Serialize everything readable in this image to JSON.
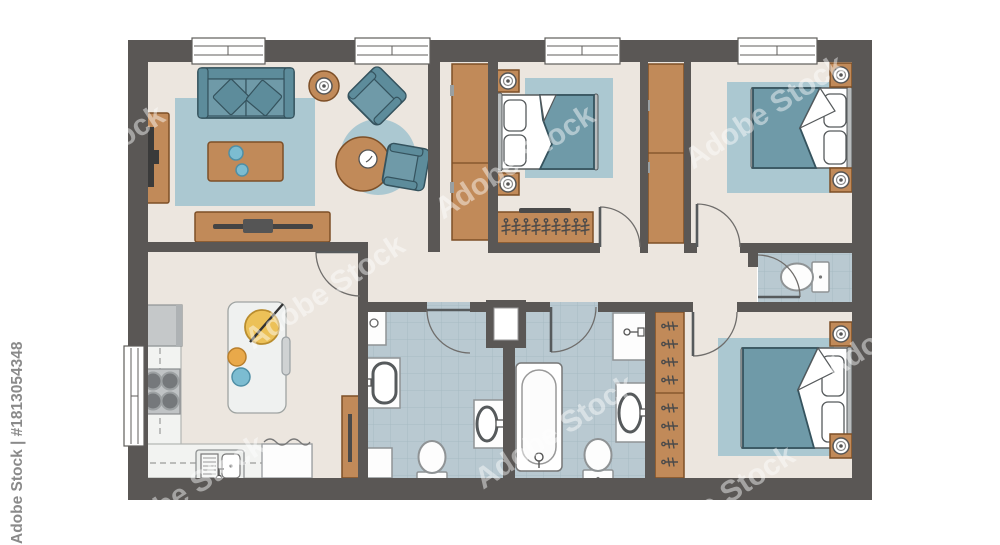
{
  "meta": {
    "description": "Architectural floor plan of a three-bedroom apartment with furniture, top view, stock illustration"
  },
  "watermark": {
    "brand": "Adobe Stock",
    "asset_id": "#1813054348",
    "full_text": "Adobe Stock | #1813054348",
    "diagonal_text": "Adobe Stock"
  },
  "colors": {
    "wall": "#5a5755",
    "floor": "#ece6df",
    "tile": "#b9c9d1",
    "tile_line": "#a6bac3",
    "rug": "#abc8d1",
    "teal": "#6f9aa8",
    "teal_dark": "#5d8c9b",
    "teal_outline": "#35535e",
    "wood": "#c18a59",
    "wood_dark": "#7d4f27",
    "counter": "#f2f3f1",
    "appliance": "#c5c8c9",
    "burner": "#75787b",
    "yellow": "#ecc158",
    "orange": "#e9a94a",
    "blue": "#7cbcd1",
    "fixture": "#fdfdfd",
    "line": "#565a5c",
    "watermark_gray": "#8a8a8a"
  },
  "plan": {
    "rooms": [
      {
        "name": "living-room",
        "items": [
          "sofa",
          "coffee-table",
          "tv-console",
          "media-sideboard",
          "armchair",
          "armchair",
          "round-coffee-table",
          "plant-side-table",
          "area-rug",
          "round-rug"
        ]
      },
      {
        "name": "kitchen",
        "items": [
          "fridge",
          "l-shaped-counter",
          "cooktop",
          "double-sink",
          "dishwasher",
          "kitchen-island",
          "cutting-board",
          "bench",
          "tall-cabinet"
        ]
      },
      {
        "name": "bedroom-top-middle",
        "items": [
          "double-bed",
          "nightstand",
          "nightstand",
          "table-lamp",
          "table-lamp",
          "area-rug",
          "wardrobe",
          "wardrobe",
          "clothes-rack"
        ]
      },
      {
        "name": "bedroom-top-right",
        "items": [
          "double-bed",
          "nightstand",
          "nightstand",
          "table-lamp",
          "table-lamp",
          "area-rug"
        ]
      },
      {
        "name": "bedroom-bottom-right",
        "items": [
          "double-bed",
          "nightstand",
          "nightstand",
          "table-lamp",
          "table-lamp",
          "area-rug",
          "open-wardrobe"
        ]
      },
      {
        "name": "bathroom-left",
        "items": [
          "sink-vanity",
          "sink-vanity",
          "toilet",
          "washing-machine",
          "wall-cabinet"
        ]
      },
      {
        "name": "bathroom-middle",
        "items": [
          "bathtub",
          "toilet",
          "sink-vanity",
          "counter"
        ]
      },
      {
        "name": "wc",
        "items": [
          "toilet"
        ]
      },
      {
        "name": "hallway",
        "items": [
          "duct"
        ]
      }
    ]
  }
}
